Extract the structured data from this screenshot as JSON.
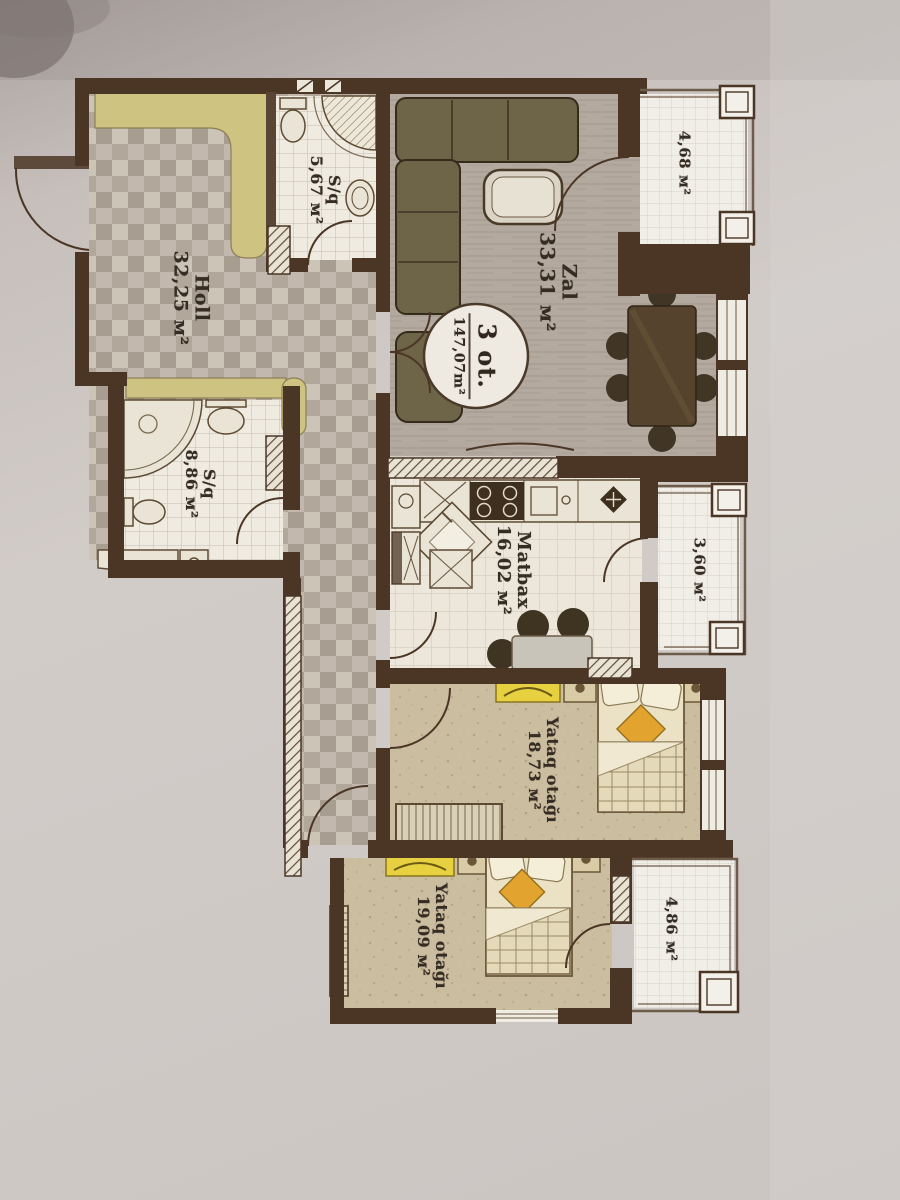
{
  "photo": {
    "description": "photo of a printed apartment floor plan, text rotated 90 degrees",
    "paper_color": "#cdc7c3",
    "wall_color": "#4b3626",
    "accent_khaki": "#cfc382",
    "accent_yellow": "#e7d140",
    "accent_orange": "#e2a42f"
  },
  "plan": {
    "stamp": {
      "line1": "3 ot.",
      "line2": "147,07m²"
    },
    "rooms": [
      {
        "name": "Zal",
        "area": "33,31 м²"
      },
      {
        "name": "S/q",
        "area": "5,67 м²"
      },
      {
        "name": "Holl",
        "area": "32,25 м²"
      },
      {
        "name": "S/q",
        "area": "8,86 м²"
      },
      {
        "name": "Matbax",
        "area": "16,02 м²"
      },
      {
        "name": "Yataq otağı",
        "area": "18,73 м²"
      },
      {
        "name": "Yataq otağı",
        "area": "19,09 м²"
      }
    ],
    "balconies": [
      {
        "area": "4,68 м²"
      },
      {
        "area": "3,60 м²"
      },
      {
        "area": "4,86 м²"
      }
    ]
  }
}
